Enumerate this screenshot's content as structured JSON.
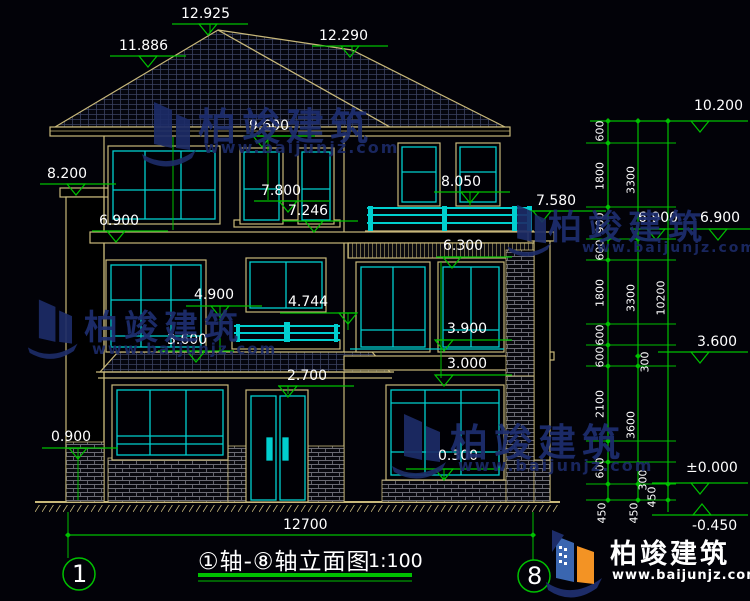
{
  "watermark": {
    "brand": "柏竣建筑",
    "site": "www.baijunjz.com"
  },
  "logo": {
    "brand": "柏竣建筑",
    "site": "www.baijunjz.com"
  },
  "footer": {
    "overall_width": "12700",
    "axis_left": "1",
    "axis_right": "8",
    "title": "①轴-⑧轴立面图",
    "scale": "1:100"
  },
  "elevations": {
    "roof_peak": "12.925",
    "roof_left": "11.886",
    "roof_right": "12.290",
    "top_right": "10.200",
    "eave": "9.600",
    "left_upper": "8.200",
    "terrace_rail_top": "8.050",
    "win3_top": "7.800",
    "terrace_rail_mid": "7.580",
    "win3_sill": "7.246",
    "slab_left": "6.900",
    "slab_mid": "6.900",
    "slab_right": "6.900",
    "tile_band": "6.300",
    "win2_top": "4.900",
    "balcony_rail": "4.744",
    "floor2_left": "3.600",
    "floor2_right": "3.600",
    "win2r_sill": "3.900",
    "slab2_right": "3.000",
    "canopy_bottom": "2.700",
    "base_left": "0.900",
    "win1_sill": "0.300",
    "zero": "±0.000",
    "ground": "-0.450"
  },
  "dim_chain_inner": [
    "600",
    "1800",
    "900",
    "600",
    "1800",
    "600",
    "600",
    "2100",
    "600",
    "450"
  ],
  "dim_chain_mid": [
    "3300",
    "3300",
    "300",
    "3600",
    "300",
    "450",
    "450"
  ],
  "dim_chain_outer": [
    "10200"
  ],
  "colors": {
    "outline_tan": "#C8B87A",
    "glazing_cyan": "#00CFCF",
    "dimension_green": "#00C000",
    "watermark_navy": "#1E2E70",
    "background": "#020208"
  }
}
